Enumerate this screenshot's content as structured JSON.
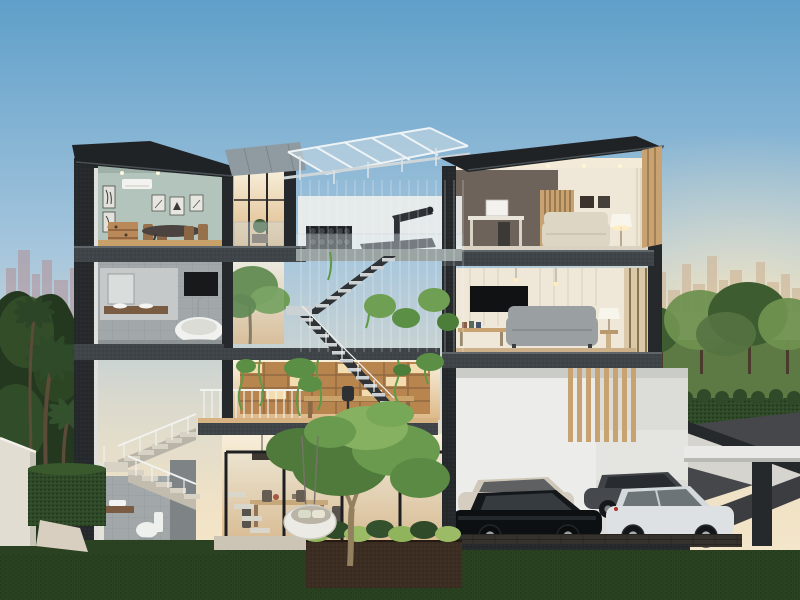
{
  "scene": {
    "description": "Dusk 3D cutaway rendering of a modern three-storey house with rooftop gym terrace, central atrium staircase, courtyard tree and basement garage",
    "sky": "clear dusk gradient, blue to warm cream",
    "left_horizon": "hazy city skyline",
    "right_horizon": "hazy city skyline with sun glow",
    "surroundings": [
      "park lawn with trees",
      "hedge rows",
      "palm trees",
      "white fence",
      "driveway ramp"
    ]
  },
  "colors": {
    "sky_top": "#5f9fc9",
    "sky_mid": "#a6c6dd",
    "sky_low": "#dcdacd",
    "sky_horizon": "#f2e3c6",
    "sun_glow": "#ffe9bd",
    "skyline_left": "#b29096",
    "skyline_right": "#cdb394",
    "structure": "#26292c",
    "slab": "#3f4449",
    "roof_dark": "#202326",
    "roof_gray": "#8f9ba1",
    "canopy_glass": "#ccdbe4",
    "sage_wall": "#b2c4bb",
    "taupe_wall": "#6e635a",
    "cream_wall": "#efe8d8",
    "white_wall": "#e9e8e4",
    "tile_gray": "#a2a8aa",
    "tile_light": "#c6c9c9",
    "wood": "#b9895a",
    "wood_light": "#d7b384",
    "timber": "#c8a271",
    "shelf_wood": "#b9854e",
    "warm_hi": "#f8f0dc",
    "warm_lo": "#ddb887",
    "sofa_beige": "#ddd6c4",
    "sofa_gray": "#9aa0a2",
    "tub_white": "#f1f2f0",
    "glass_frame": "#1d1f21",
    "glass_tint": "#bcd1da",
    "railing_white": "#f2f2f0",
    "tread_light": "#ccd1d3",
    "tree_dark": "#24381f",
    "tree_mid": "#3d5c30",
    "tree_light": "#6f9150",
    "vine_green": "#5f9a49",
    "canopy_tree": "#58833f",
    "lawn_dark": "#2a4222",
    "park_lawn": "#5d7a44",
    "hedge": "#2f4a28",
    "road": "#46474a",
    "ramp": "#3c3d40",
    "soil": "#3b2d21",
    "fence_white": "#e2ddd2",
    "path_beige": "#d8cfc0",
    "car_cream": "#d5cec0",
    "car_gray": "#45494e",
    "car_black": "#0d1013",
    "car_white": "#dde1e4",
    "plank_floor": "#35312c",
    "egg_chair": "#eceae4",
    "pendant_black": "#2b2218",
    "terrace_tile": "#ccc5b6",
    "retaining_white": "#d6d4ce"
  },
  "house": {
    "levels": [
      {
        "name": "rooftop",
        "spaces": [
          {
            "name": "glass-canopy",
            "objects": [
              "steel-glass pergola",
              "suspension-cable screen"
            ]
          },
          {
            "name": "gym-terrace",
            "objects": [
              "treadmill",
              "dumbbell-rack",
              "glass-balustrade",
              "stair-flight"
            ]
          }
        ]
      },
      {
        "name": "third-floor",
        "spaces": [
          {
            "name": "dining-room",
            "wall_color": "#b2c4bb",
            "objects": [
              "dining-table",
              "chairs",
              "art-frames",
              "air-conditioner",
              "wood-shelf",
              "downlights"
            ]
          },
          {
            "name": "balcony",
            "objects": [
              "glass-railing",
              "potted-plant",
              "warm-lit glazing"
            ]
          },
          {
            "name": "family-room",
            "wall_color": "#6e635a",
            "objects": [
              "desk",
              "desk-chair",
              "timber-slat-panel",
              "beige-sofa",
              "table-lamp",
              "curtains",
              "picture-frames"
            ]
          }
        ]
      },
      {
        "name": "second-floor",
        "spaces": [
          {
            "name": "bathroom",
            "objects": [
              "freestanding-bathtub",
              "vanity-mirror",
              "dark-wall-panel",
              "standing-faucet"
            ]
          },
          {
            "name": "atrium",
            "objects": [
              "slender-trees",
              "hanging-vines",
              "zigzag-staircase"
            ]
          },
          {
            "name": "living-room",
            "objects": [
              "wall-tv",
              "gray-sofa",
              "media-bench",
              "table-lamp",
              "pendant-lights",
              "timber-mullion-door"
            ]
          }
        ]
      },
      {
        "name": "mezzanine",
        "spaces": [
          {
            "name": "library-study",
            "objects": [
              "lit-bookshelf-wall",
              "desk",
              "office-chair",
              "white-railing",
              "wood-floor"
            ]
          }
        ]
      },
      {
        "name": "ground-floor",
        "spaces": [
          {
            "name": "powder-room",
            "objects": [
              "floating-vanity",
              "toilet"
            ]
          },
          {
            "name": "side-staircase",
            "objects": [
              "switchback-stairs",
              "white-post-railing"
            ]
          },
          {
            "name": "dining-lounge",
            "objects": [
              "glass-sliding-doors",
              "dining-table",
              "chairs",
              "linear-pendant",
              "floating-steps",
              "hanging-egg-chair"
            ]
          },
          {
            "name": "courtyard",
            "objects": [
              "frangipani-tree",
              "soil-planter",
              "ground-plants"
            ]
          },
          {
            "name": "garage",
            "objects": [
              "four-cars",
              "timber-louvers",
              "plank-floor",
              "driveway-ramp",
              "carport-canopy",
              "charcoal-column"
            ]
          }
        ]
      }
    ]
  },
  "vehicles": [
    {
      "type": "sedan",
      "color": "#d5cec0",
      "position": "rear-left"
    },
    {
      "type": "sedan",
      "color": "#45494e",
      "position": "rear-right"
    },
    {
      "type": "sedan",
      "color": "#0d1013",
      "position": "front-left"
    },
    {
      "type": "suv",
      "color": "#dde1e4",
      "position": "front-right"
    }
  ],
  "vegetation": [
    "palm-trees",
    "dark-background-trees",
    "park-trees",
    "hedge-row",
    "box-hedge",
    "courtyard-tree",
    "atrium-trees",
    "hanging-vines",
    "lawn",
    "planter-plants"
  ]
}
